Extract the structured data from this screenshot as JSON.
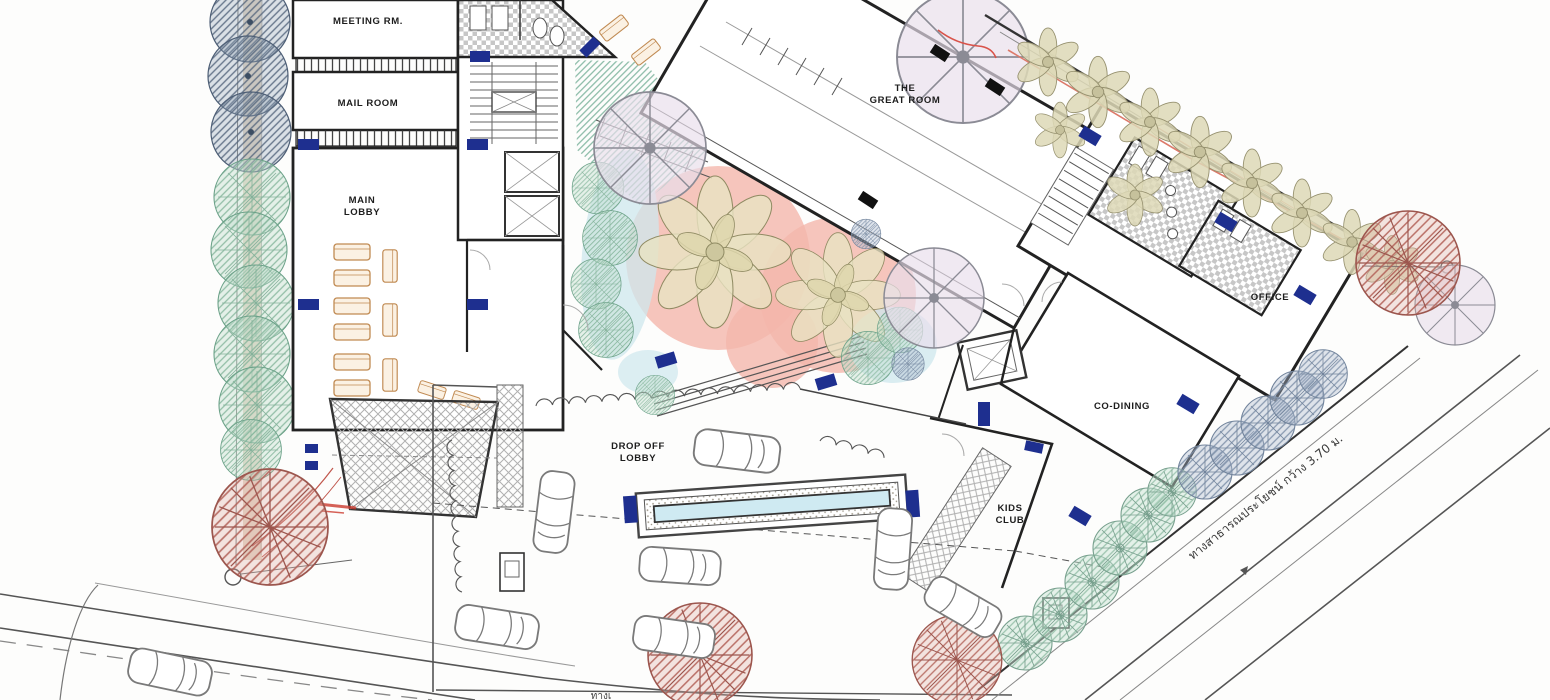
{
  "plan": {
    "rooms": {
      "meeting": {
        "label": "MEETING RM."
      },
      "mail": {
        "label": "MAIL ROOM"
      },
      "main_lobby": {
        "line1": "MAIN",
        "line2": "LOBBY"
      },
      "great_room": {
        "line1": "THE",
        "line2": "GREAT ROOM"
      },
      "office": {
        "label": "OFFICE"
      },
      "co_dining": {
        "label": "CO-DINING"
      },
      "kids_club": {
        "line1": "KIDS",
        "line2": "CLUB"
      },
      "drop_off": {
        "line1": "DROP OFF",
        "line2": "LOBBY"
      }
    },
    "annotations": {
      "right_road": "ทางสาธารณประโยชน์ กว้าง 3.70 ม.",
      "bottom_road_partial": "ทางเ"
    },
    "colors": {
      "wall": "#222222",
      "navy_marker": "#1e2f8f",
      "salmon_paving": "#f4b6ab",
      "water": "#cde7ee",
      "teal_tree": "#66a68c",
      "slate_tree": "#54657c",
      "olive_tree": "#b3ae8a",
      "red_tree": "#b26158",
      "lavender_canopy": "#e9dfec",
      "furniture": "#c08a52",
      "red_line": "#dd7a6a"
    }
  }
}
